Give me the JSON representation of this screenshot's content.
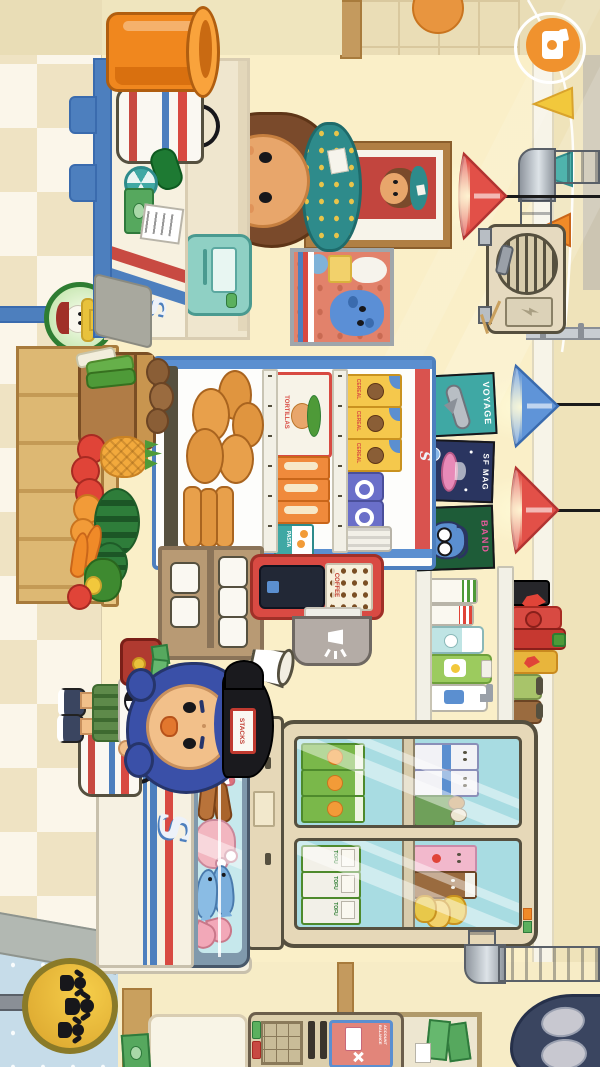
{
  "app": {
    "name": "Toca-style supermarket scene",
    "orientation": "landscape scene shown rotated in portrait screenshot"
  },
  "hud": {
    "camera_button": {
      "icon": "photo-camera-icon",
      "color": "#F0922E"
    }
  },
  "decor": {
    "pennant_colors": [
      "#F2C83C",
      "#4FB3AC",
      "#F08A28"
    ],
    "lamp_colors": [
      "#E25048",
      "#5F94D8",
      "#E25048"
    ],
    "employee_plaque": "EMPLOYEE OF THE MONTH",
    "poster": "blue pet with soft-serve on salmon poster",
    "wall_color": "#FAEFC8",
    "floor": "beige diagonal checker",
    "heater": "wall furnace with round grille and duct"
  },
  "checkout": {
    "logo": "S",
    "counter_color": "#F7F1E0",
    "items_on_counter": [
      "striped shopping bag",
      "zucchini",
      "sticker roll",
      "cash",
      "receipt"
    ],
    "register": "mint card register"
  },
  "cashier": {
    "hat": "teal pineapple bucket hat",
    "hair": "brown",
    "shirt_badge": "lightning-bolt-badge"
  },
  "customer": {
    "cap_patch": "STACKS",
    "hair": "blue",
    "shorts": "green striped",
    "holding": [
      "red wallet with cash",
      "striped bag with watermelon"
    ]
  },
  "shelf": {
    "logo": "S",
    "frame_color": "#4D7FBE",
    "cereal_label": "CEREAL",
    "tortilla_label": "TORTILLAS",
    "pasta_label": "PASTA",
    "rows": [
      "cereal boxes + donut packs + crinkle bag",
      "tortillas + spaghetti boxes + pasta pack",
      "bread buns"
    ]
  },
  "magazines": [
    {
      "title": "VOYAGE"
    },
    {
      "title": "SF MAG"
    },
    {
      "title": "BAND"
    }
  ],
  "coffee_machine": {
    "label": "COFFEE",
    "color": "#D94A43"
  },
  "paper_rolls": {
    "count": 5
  },
  "produce": {
    "sign": "farmer-face produce sign",
    "items": [
      "potato sack",
      "leeks",
      "tomatoes",
      "pineapple",
      "oranges",
      "watermelons",
      "carrots",
      "pepper and greens"
    ]
  },
  "toiletries_shelf": [
    "striped toothpaste tubes",
    "polar bear lotion",
    "duck shampoo",
    "pump soap"
  ],
  "condiments_shelf": [
    "black hot sauce",
    "ketchup",
    "sriracha",
    "flame mustard",
    "green jar",
    "brown jar"
  ],
  "deli": {
    "logo": "S",
    "tofu_label": "TOFU",
    "fridge_items": [
      "milk cartons",
      "egg tray",
      "strawberry milk",
      "chocolate milk",
      "fried chicken",
      "orange juice",
      "tofu packs"
    ],
    "case_items": [
      "bacon",
      "sausages",
      "chicken",
      "fish",
      "shrimp"
    ],
    "indicator_lights": [
      "#F08A28",
      "#5BB05E"
    ]
  },
  "atm": {
    "screen_text": "ACCOUNT BALANCE",
    "screen_color": "#E2857A"
  },
  "signs": {
    "family_sign": "gold circle with three figures",
    "money_frame": "framed dollar bills"
  }
}
